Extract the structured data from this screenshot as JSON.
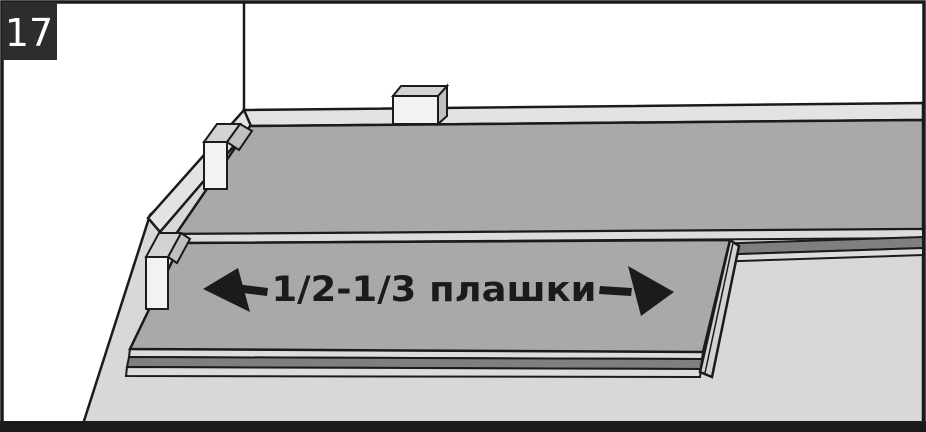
{
  "figure": {
    "step_number": "17",
    "annotation": "1/2-1/3 плашки",
    "icons": {
      "left_arrow": "◄",
      "right_arrow": "►"
    },
    "colors": {
      "wall": "#ffffff",
      "ink": "#1b1b1b",
      "plank": "#a9a9a9",
      "band_light": "#dcdcdc",
      "band_dark": "#7f7f7f",
      "floor": "#d8d8d8",
      "baseboard": "#e3e3e3",
      "spacer_front": "#f2f2f2",
      "spacer_top": "#d3d3d3",
      "spacer_side": "#c0c0c0",
      "end_face": "#d2d2d2",
      "badge_bg": "#2d2d2d",
      "badge_fg": "#ffffff"
    }
  }
}
